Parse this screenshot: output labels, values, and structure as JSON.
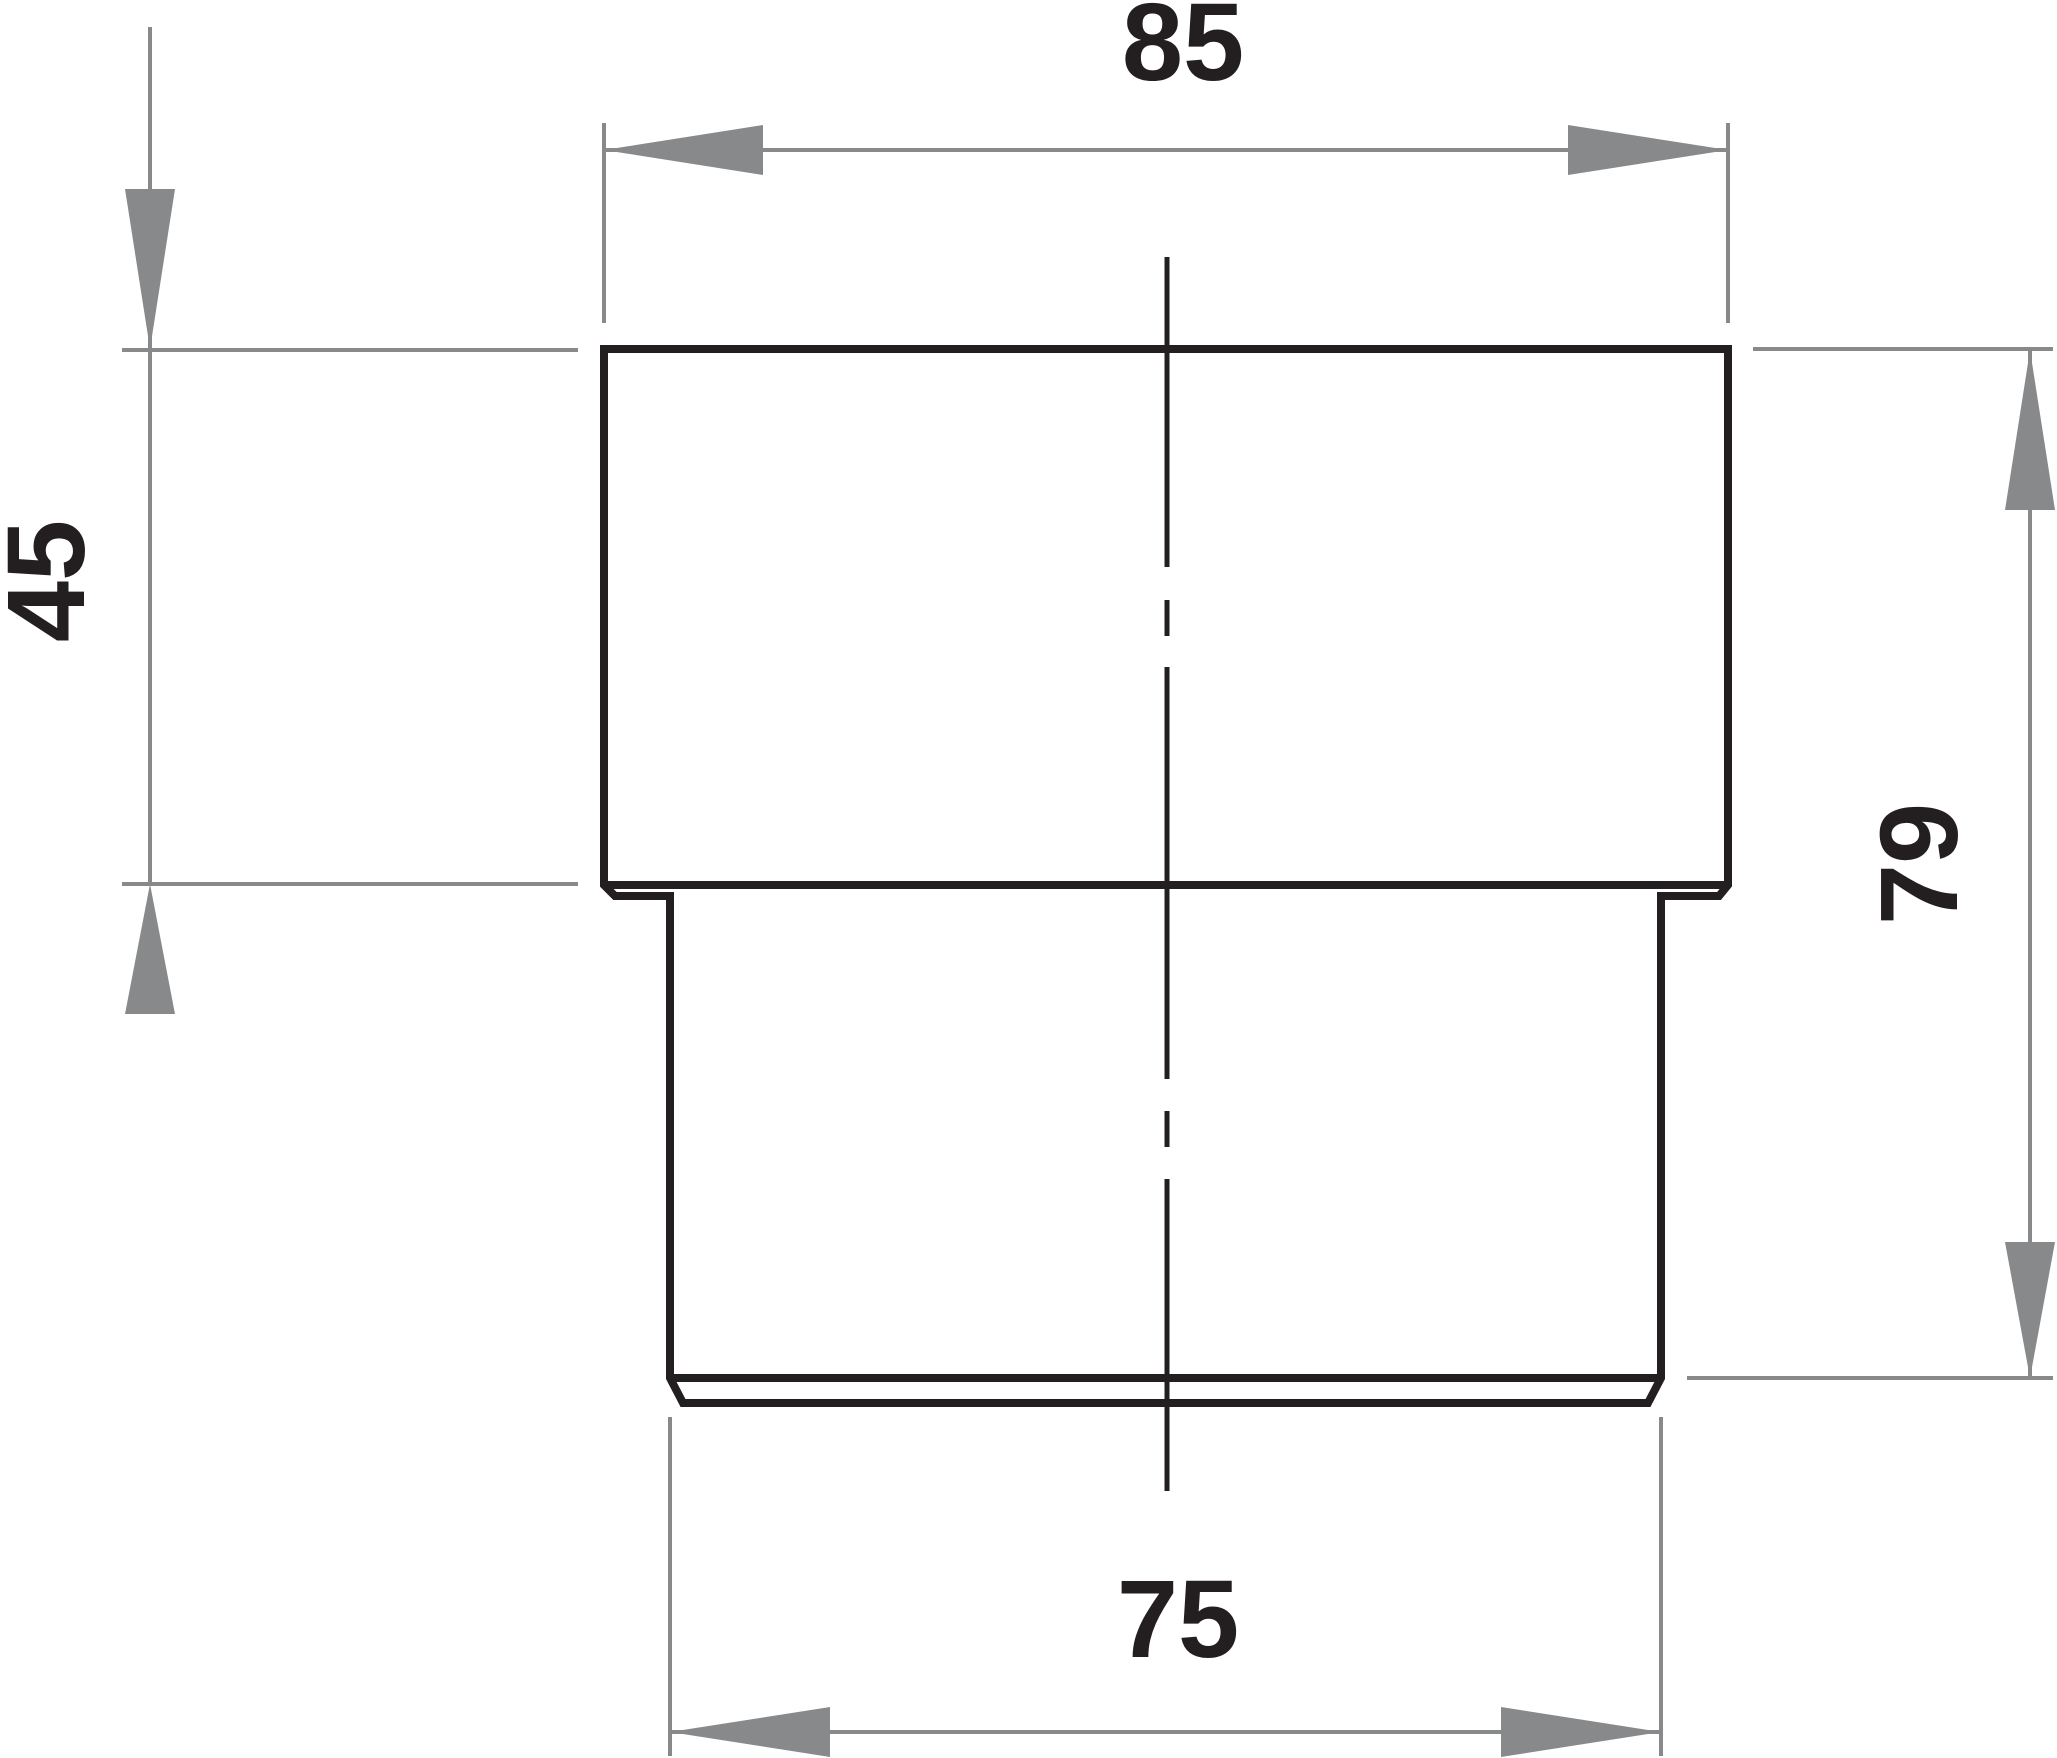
{
  "drawing": {
    "dimension_labels": {
      "top": "85",
      "left": "45",
      "right": "79",
      "bottom": "75"
    },
    "colors": {
      "outline": "#231F20",
      "dimension_gray": "#88898B",
      "label_text": "#231F20",
      "background": "#FFFFFF"
    }
  }
}
